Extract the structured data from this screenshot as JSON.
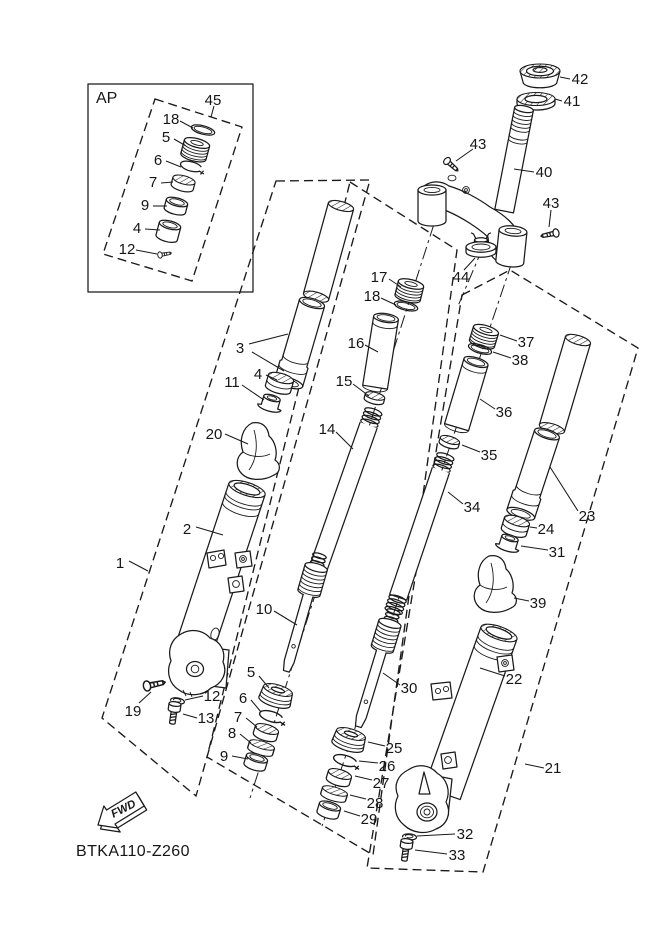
{
  "diagram": {
    "code": "BTKA110-Z260",
    "ap_box_label": "AP",
    "fwd_label": "FWD"
  },
  "part_labels": {
    "ap_box": [
      "45",
      "18",
      "5",
      "6",
      "7",
      "9",
      "4",
      "12"
    ],
    "steering": [
      "42",
      "41",
      "43",
      "40",
      "43",
      "44"
    ],
    "left_damper": [
      "17",
      "18",
      "16",
      "15",
      "14",
      "10",
      "5",
      "6",
      "7",
      "8",
      "9"
    ],
    "left_fork": [
      "3",
      "4",
      "11",
      "20",
      "2",
      "1",
      "19",
      "12",
      "13"
    ],
    "right_damper": [
      "37",
      "38",
      "36",
      "35",
      "34",
      "30",
      "25",
      "26",
      "27",
      "28",
      "29"
    ],
    "right_fork": [
      "23",
      "24",
      "31",
      "39",
      "22",
      "21",
      "32",
      "33"
    ]
  }
}
